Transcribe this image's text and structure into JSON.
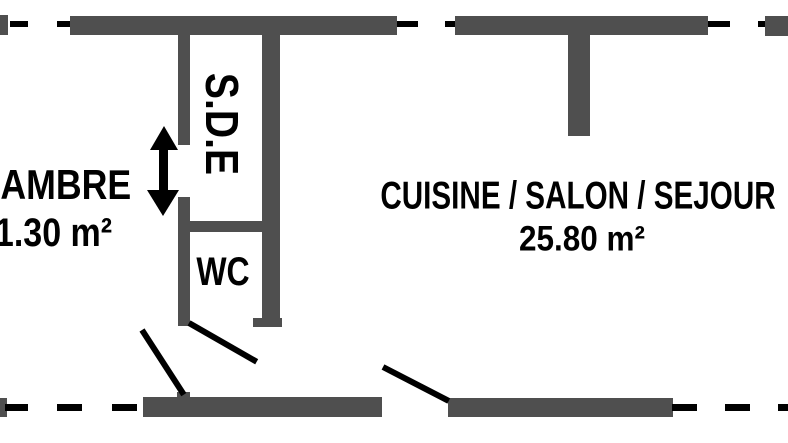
{
  "document": {
    "type": "floor-plan"
  },
  "colors": {
    "wall": "#4f4f4f",
    "line": "#000000",
    "background": "#ffffff"
  },
  "rooms": {
    "chambre": {
      "name": "CHAMBRE",
      "area": "11.30 m²"
    },
    "sde": {
      "name": "S.D.E"
    },
    "wc": {
      "name": "WC"
    },
    "cuisine": {
      "name": "CUISINE / SALON / SEJOUR",
      "area": "25.80 m²"
    }
  }
}
